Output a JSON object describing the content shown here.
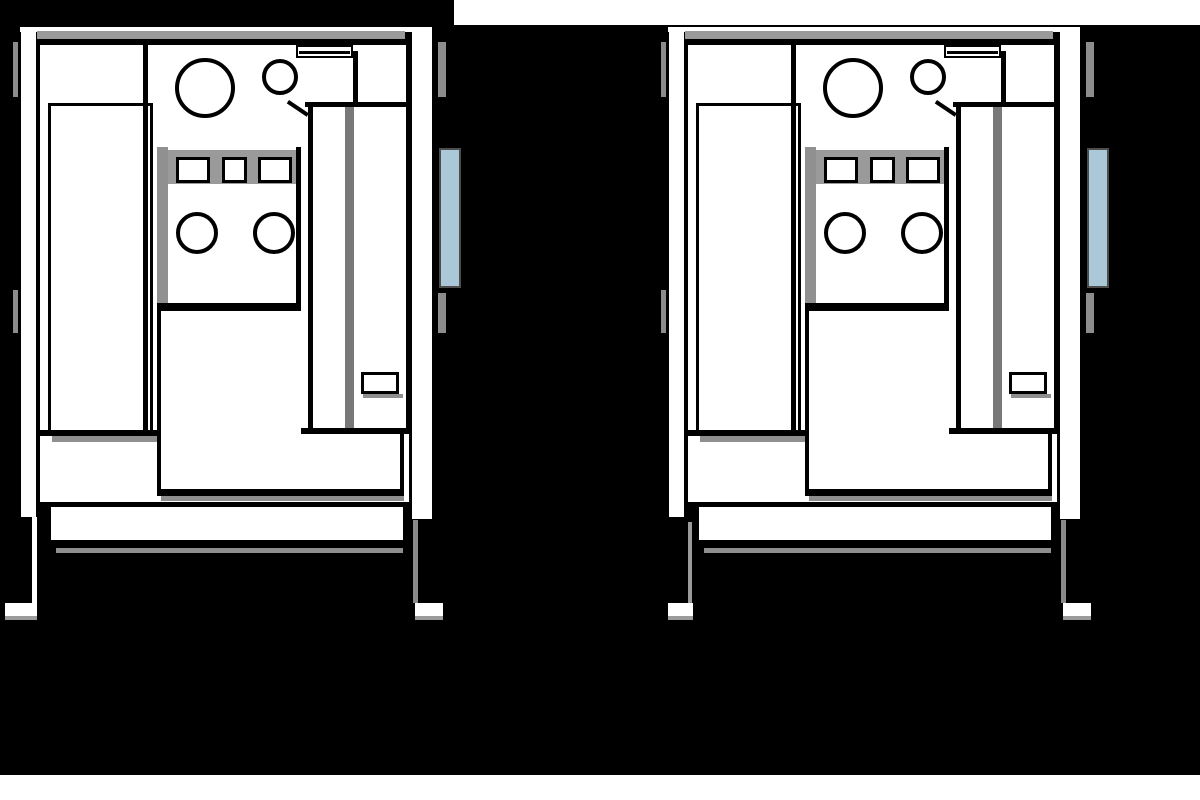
{
  "page": {
    "background": "#ffffff",
    "figure_background": "#000000",
    "black_region_left": {
      "x": 0,
      "y": 0,
      "w": 454,
      "h": 775
    },
    "black_region_main": {
      "x": 454,
      "y": 25,
      "w": 746,
      "h": 750
    }
  },
  "diagram": {
    "description": "Two side-by-side black-and-white technical front-view line drawings of an industrial cabinet machine with control panel, doors, side handle and legs",
    "colors": {
      "outline": "#000000",
      "panel_fill": "#ffffff",
      "shadow": "#8f8f8f",
      "shade_light": "#9a9a9a",
      "handle_fill": "#abc8d9",
      "handle_border": "#4d4d4d"
    },
    "machines": [
      {
        "id": "machine-left",
        "x": 18,
        "y": 25,
        "variant": "a"
      },
      {
        "id": "machine-right",
        "x": 666,
        "y": 25,
        "variant": "b"
      }
    ],
    "parts_common": [
      {
        "n": "left-edge-line",
        "x": 0,
        "y": 1,
        "w": 3,
        "h": 494,
        "f": "#000000"
      },
      {
        "n": "left-side-band",
        "x": 3,
        "y": 1,
        "w": 15,
        "h": 491,
        "f": "#ffffff"
      },
      {
        "n": "top-strip",
        "x": 2,
        "y": 0,
        "w": 412,
        "h": 7,
        "f": "#ffffff",
        "bt": "2px solid #000000"
      },
      {
        "n": "top-face-shade",
        "x": 19,
        "y": 6,
        "w": 368,
        "h": 8,
        "f": "#9a9a9a"
      },
      {
        "n": "top-edge-line",
        "x": 19,
        "y": 14,
        "w": 372,
        "h": 7,
        "f": "#000000"
      },
      {
        "n": "inner-left-line",
        "x": 18,
        "y": 14,
        "w": 4,
        "h": 468,
        "f": "#000000"
      },
      {
        "n": "interior-panel",
        "x": 22,
        "y": 20,
        "w": 366,
        "h": 390,
        "f": "#ffffff"
      },
      {
        "n": "right-door-edge-line",
        "x": 388,
        "y": 14,
        "w": 6,
        "h": 396,
        "f": "#000000"
      },
      {
        "n": "right-side-band",
        "x": 394,
        "y": 0,
        "w": 20,
        "h": 494,
        "f": "#ffffff",
        "bt": "2px solid #000000"
      },
      {
        "n": "right-edge-line",
        "x": 414,
        "y": 1,
        "w": 6,
        "h": 493,
        "f": "#000000"
      },
      {
        "n": "hinge-right-upper",
        "x": 420,
        "y": 17,
        "w": 8,
        "h": 55,
        "f": "#8c8c8c"
      },
      {
        "n": "hinge-right-lower",
        "x": 420,
        "y": 268,
        "w": 8,
        "h": 40,
        "f": "#8c8c8c"
      },
      {
        "n": "side-handle",
        "x": 421,
        "y": 123,
        "w": 22,
        "h": 140,
        "f": "#abc8d9",
        "b": "2px solid #4d4d4d"
      },
      {
        "n": "hinge-left-upper",
        "x": -5,
        "y": 17,
        "w": 5,
        "h": 55,
        "f": "#8c8c8c"
      },
      {
        "n": "hinge-left-lower",
        "x": -5,
        "y": 265,
        "w": 5,
        "h": 43,
        "f": "#8c8c8c"
      },
      {
        "n": "left-door",
        "x": 30,
        "y": 78,
        "w": 105,
        "h": 333,
        "f": "#ffffff",
        "b": "3px solid #000000"
      },
      {
        "n": "center-divider-line",
        "x": 125,
        "y": 20,
        "w": 5,
        "h": 390,
        "f": "#000000"
      },
      {
        "n": "control-side-shade",
        "x": 139,
        "y": 122,
        "w": 11,
        "h": 164,
        "f": "#909090"
      },
      {
        "n": "button-row-shade",
        "x": 150,
        "y": 125,
        "w": 128,
        "h": 34,
        "f": "#9a9a9a"
      },
      {
        "n": "button-1",
        "x": 158,
        "y": 132,
        "w": 34,
        "h": 26,
        "f": "#ffffff",
        "b": "3px solid #000000"
      },
      {
        "n": "button-2",
        "x": 204,
        "y": 132,
        "w": 25,
        "h": 26,
        "f": "#ffffff",
        "b": "3px solid #000000"
      },
      {
        "n": "button-3",
        "x": 240,
        "y": 132,
        "w": 34,
        "h": 26,
        "f": "#ffffff",
        "b": "3px solid #000000"
      },
      {
        "n": "panel-right-line",
        "x": 278,
        "y": 122,
        "w": 5,
        "h": 164,
        "f": "#000000"
      },
      {
        "n": "panel-bottom-line",
        "x": 139,
        "y": 278,
        "w": 144,
        "h": 8,
        "f": "#000000"
      },
      {
        "n": "knob-1",
        "x": 158,
        "y": 187,
        "w": 42,
        "h": 42,
        "f": "#ffffff",
        "b": "4px solid #000000",
        "rd": "50%"
      },
      {
        "n": "knob-2",
        "x": 235,
        "y": 187,
        "w": 42,
        "h": 42,
        "f": "#ffffff",
        "b": "4px solid #000000",
        "rd": "50%"
      },
      {
        "n": "gauge-large",
        "x": 157,
        "y": 33,
        "w": 60,
        "h": 60,
        "f": "#ffffff",
        "b": "4px solid #000000",
        "rd": "50%"
      },
      {
        "n": "gauge-small",
        "x": 244,
        "y": 34,
        "w": 36,
        "h": 36,
        "f": "#ffffff",
        "b": "4px solid #000000",
        "rd": "50%"
      },
      {
        "n": "top-slot",
        "x": 278,
        "y": 20,
        "w": 57,
        "h": 13,
        "f": "#ffffff",
        "b": "2px solid #000000"
      },
      {
        "n": "top-slot-line",
        "x": 281,
        "y": 26,
        "w": 51,
        "h": 3,
        "f": "#000000"
      },
      {
        "n": "slot-side-line",
        "x": 335,
        "y": 26,
        "w": 5,
        "h": 52,
        "f": "#000000"
      },
      {
        "n": "column-top-line",
        "x": 287,
        "y": 77,
        "w": 103,
        "h": 5,
        "f": "#000000"
      },
      {
        "n": "corner-diagonal",
        "x": 271,
        "y": 75,
        "w": 24,
        "h": 4,
        "f": "#000000",
        "rot": 34
      },
      {
        "n": "column-left-line",
        "x": 290,
        "y": 82,
        "w": 5,
        "h": 326,
        "f": "#000000"
      },
      {
        "n": "column-divider-shade",
        "x": 327,
        "y": 82,
        "w": 9,
        "h": 326,
        "f": "#787878"
      },
      {
        "n": "door-vent",
        "x": 343,
        "y": 347,
        "w": 38,
        "h": 22,
        "f": "#ffffff",
        "b": "3px solid #000000"
      },
      {
        "n": "door-vent-shadow",
        "x": 345,
        "y": 369,
        "w": 40,
        "h": 4,
        "f": "#8f8f8f"
      },
      {
        "n": "base-area",
        "x": 22,
        "y": 408,
        "w": 369,
        "h": 74,
        "f": "#ffffff"
      },
      {
        "n": "base-line-left",
        "x": 19,
        "y": 405,
        "w": 121,
        "h": 6,
        "f": "#000000"
      },
      {
        "n": "left-door-shadow",
        "x": 34,
        "y": 411,
        "w": 106,
        "h": 6,
        "f": "#8f8f8f"
      },
      {
        "n": "base-line-right",
        "x": 283,
        "y": 403,
        "w": 108,
        "h": 6,
        "f": "#000000"
      },
      {
        "n": "lower-door-left-line",
        "x": 139,
        "y": 286,
        "w": 4,
        "h": 184,
        "f": "#000000"
      },
      {
        "n": "lower-door-bottom-line",
        "x": 139,
        "y": 464,
        "w": 247,
        "h": 7,
        "f": "#000000"
      },
      {
        "n": "lower-door-right-line",
        "x": 382,
        "y": 405,
        "w": 4,
        "h": 61,
        "f": "#000000"
      },
      {
        "n": "lower-door-shadow",
        "x": 143,
        "y": 471,
        "w": 243,
        "h": 5,
        "f": "#8f8f8f"
      },
      {
        "n": "base-bottom-line",
        "x": 19,
        "y": 477,
        "w": 372,
        "h": 5,
        "f": "#000000"
      },
      {
        "n": "plinth",
        "x": 33,
        "y": 482,
        "w": 352,
        "h": 33,
        "f": "#ffffff"
      },
      {
        "n": "plinth-bottom-line",
        "x": 33,
        "y": 515,
        "w": 352,
        "h": 8,
        "f": "#000000"
      },
      {
        "n": "plinth-shadow",
        "x": 38,
        "y": 523,
        "w": 347,
        "h": 5,
        "f": "#8f8f8f"
      }
    ],
    "parts_a": [
      {
        "n": "left-leg",
        "x": 14,
        "y": 492,
        "w": 5,
        "h": 86,
        "f": "#ffffff"
      },
      {
        "n": "left-foot",
        "x": -13,
        "y": 578,
        "w": 32,
        "h": 17,
        "f": "#ffffff",
        "bb": "4px solid #9a9a9a"
      },
      {
        "n": "right-leg",
        "x": 395,
        "y": 495,
        "w": 5,
        "h": 83,
        "f": "#8a8a8a"
      },
      {
        "n": "right-foot",
        "x": 397,
        "y": 578,
        "w": 28,
        "h": 17,
        "f": "#ffffff",
        "bb": "4px solid #9a9a9a"
      }
    ],
    "parts_b": [
      {
        "n": "left-leg",
        "x": 22,
        "y": 497,
        "w": 4,
        "h": 81,
        "f": "#9a9a9a"
      },
      {
        "n": "left-foot",
        "x": 2,
        "y": 578,
        "w": 25,
        "h": 17,
        "f": "#ffffff",
        "bb": "4px solid #9a9a9a"
      },
      {
        "n": "right-leg",
        "x": 395,
        "y": 495,
        "w": 5,
        "h": 83,
        "f": "#8a8a8a"
      },
      {
        "n": "right-foot",
        "x": 397,
        "y": 578,
        "w": 28,
        "h": 17,
        "f": "#ffffff",
        "bb": "4px solid #9a9a9a"
      }
    ]
  }
}
